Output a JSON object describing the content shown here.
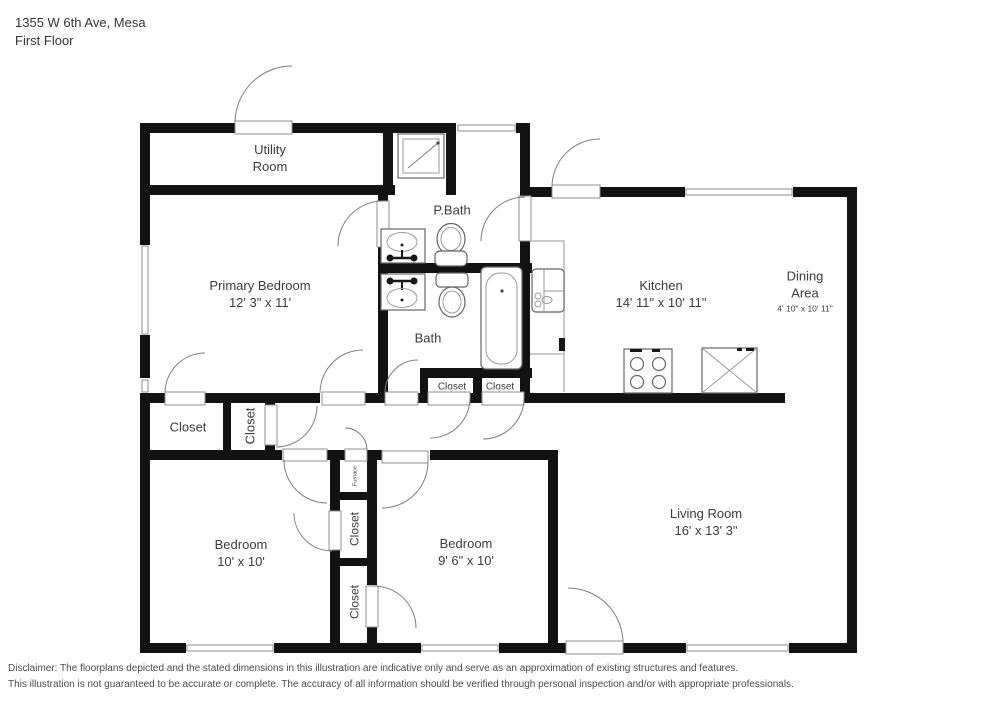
{
  "header": {
    "address": "1355 W 6th Ave, Mesa",
    "floor_label": "First Floor"
  },
  "rooms": {
    "utility": {
      "line1": "Utility",
      "line2": "Room"
    },
    "primary_bedroom": {
      "name": "Primary Bedroom",
      "dims": "12' 3\" x 11'"
    },
    "p_bath": {
      "name": "P.Bath"
    },
    "bath": {
      "name": "Bath"
    },
    "kitchen": {
      "name": "Kitchen",
      "dims": "14' 11\" x 10' 11\""
    },
    "dining": {
      "line1": "Dining",
      "line2": "Area",
      "dims": "4' 10\" x 10' 11\""
    },
    "living": {
      "name": "Living Room",
      "dims": "16' x 13' 3\""
    },
    "bedroom1": {
      "name": "Bedroom",
      "dims": "10' x 10'"
    },
    "bedroom2": {
      "name": "Bedroom",
      "dims": "9' 6\" x 10'"
    },
    "closet_hall": {
      "name": "Closet"
    },
    "closet_hall_vertical": {
      "name": "Closet"
    },
    "closet_bath_left": {
      "name": "Closet"
    },
    "closet_bath_right": {
      "name": "Closet"
    },
    "furnace": {
      "name": "Furnace"
    },
    "closet_middle": {
      "name": "Closet"
    },
    "closet_bottom": {
      "name": "Closet"
    }
  },
  "fixture_icons": [
    "shower-icon",
    "vanity-sink-icon",
    "toilet-icon",
    "bathtub-icon",
    "kitchen-sink-icon",
    "stove-icon",
    "cabinet-x-icon",
    "door-icon",
    "window-icon"
  ],
  "colors": {
    "wall": "#121212",
    "fixture_line": "#666666",
    "text": "#3b3b3b"
  },
  "footer": {
    "line1": "Disclaimer: The floorplans depicted and the stated dimensions in this illustration are indicative only and serve as an approximation of existing structures and features.",
    "line2": "This illustration is not guaranteed to be accurate or complete. The accuracy of all information should be verified through personal inspection and/or with appropriate professionals."
  }
}
